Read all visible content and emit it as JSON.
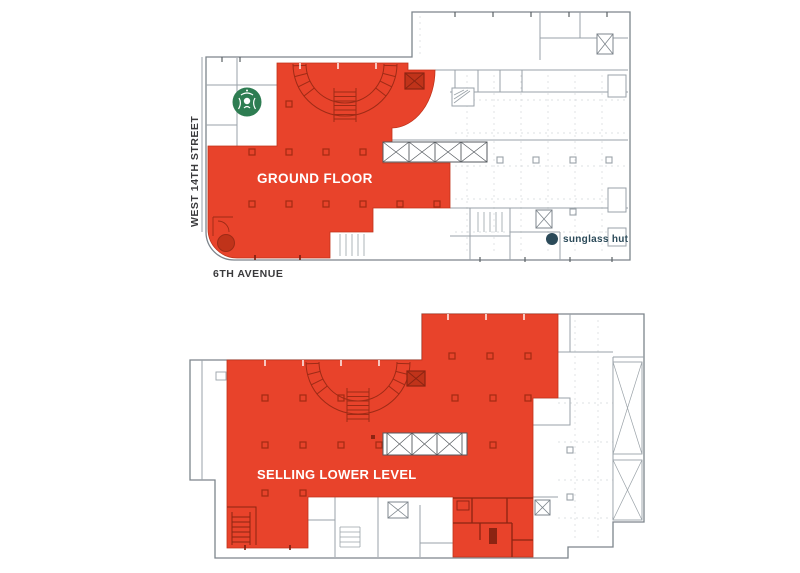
{
  "canvas": {
    "width": 800,
    "height": 573,
    "background": "#FFFFFF"
  },
  "colors": {
    "highlight_red": "#E8432B",
    "highlight_red_dark": "#C0331A",
    "detail_dark_red": "#9E2B16",
    "plan_line_gray": "#7D858C",
    "grid_line_gray": "#D3D7DA",
    "street_text": "#3A3A3C",
    "starbucks_green": "#2E7D52",
    "sunglass_hut_navy": "#2B4A59"
  },
  "ground_floor": {
    "label": "GROUND FLOOR",
    "west_street_label": "WEST 14TH STREET",
    "avenue_label": "6TH AVENUE",
    "sunglass_hut_label": "sunglass hut",
    "icons": {
      "starbucks": "starbucks-siren-logo",
      "sunglass_hut_dot": "filled-circle"
    }
  },
  "lower_level": {
    "label": "SELLING LOWER LEVEL"
  }
}
